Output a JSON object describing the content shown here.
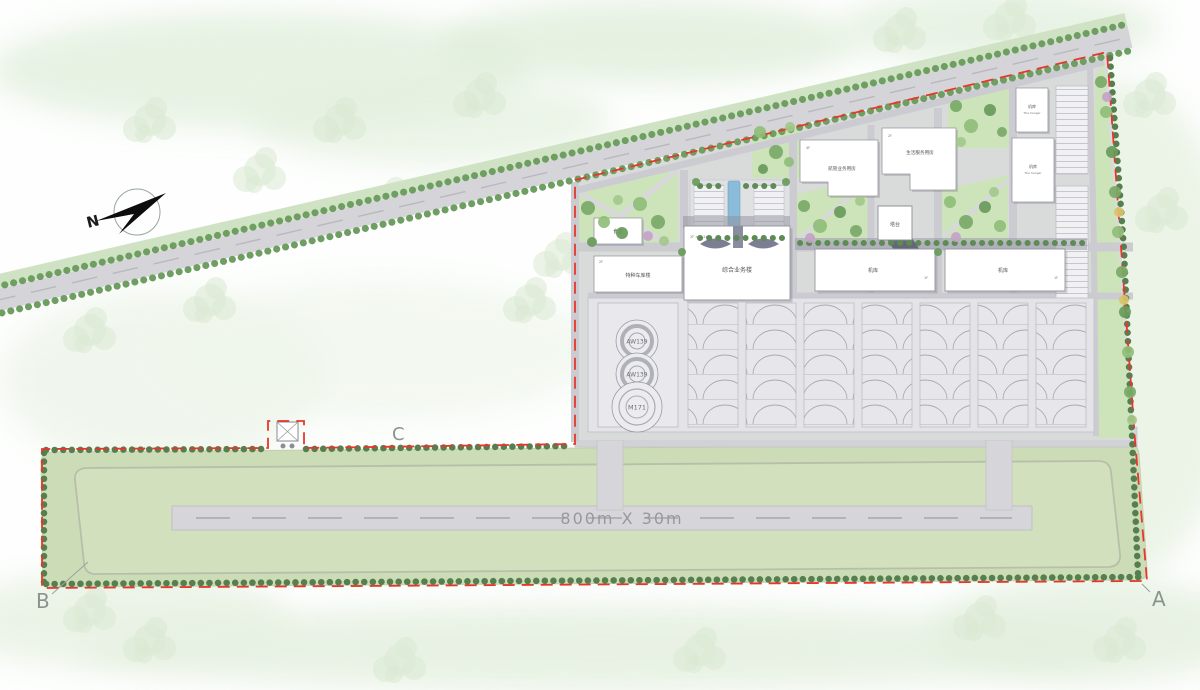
{
  "plan": {
    "north_label": "N",
    "runway_label": "800m X 30m",
    "corner_a": "A",
    "corner_b": "B",
    "corner_c": "C",
    "helipads": [
      {
        "label": "AW139"
      },
      {
        "label": "AW139"
      },
      {
        "label": "M171"
      }
    ],
    "buildings": {
      "terminal": {
        "name": "综合业务楼",
        "tag": "2F +16.2m"
      },
      "atc_ops": {
        "name": "航管业务用房",
        "tag": "4F"
      },
      "life_service": {
        "name": "生活服务用房",
        "tag": "2F"
      },
      "tower": {
        "name": "塔台"
      },
      "hangar_west": {
        "name": "机库",
        "tag": "1F"
      },
      "hangar_east": {
        "name": "机库",
        "tag": "1F"
      },
      "vehicle_garage": {
        "name": "特种车库楼",
        "tag": "2F"
      },
      "canteen": {
        "name": "食堂"
      },
      "hangar_small": {
        "name": "机库",
        "subtitle": "The hangar"
      },
      "hangar_tall": {
        "name": "机库",
        "subtitle": "The hangar"
      }
    },
    "colors": {
      "boundary_red": "#e5382a",
      "field_green": "#ccdcb6",
      "road_gray": "#d5d5d9",
      "apron_gray": "#e4e4e8",
      "tree_green": "#7aa967",
      "water_blue": "#8abbd9"
    }
  }
}
